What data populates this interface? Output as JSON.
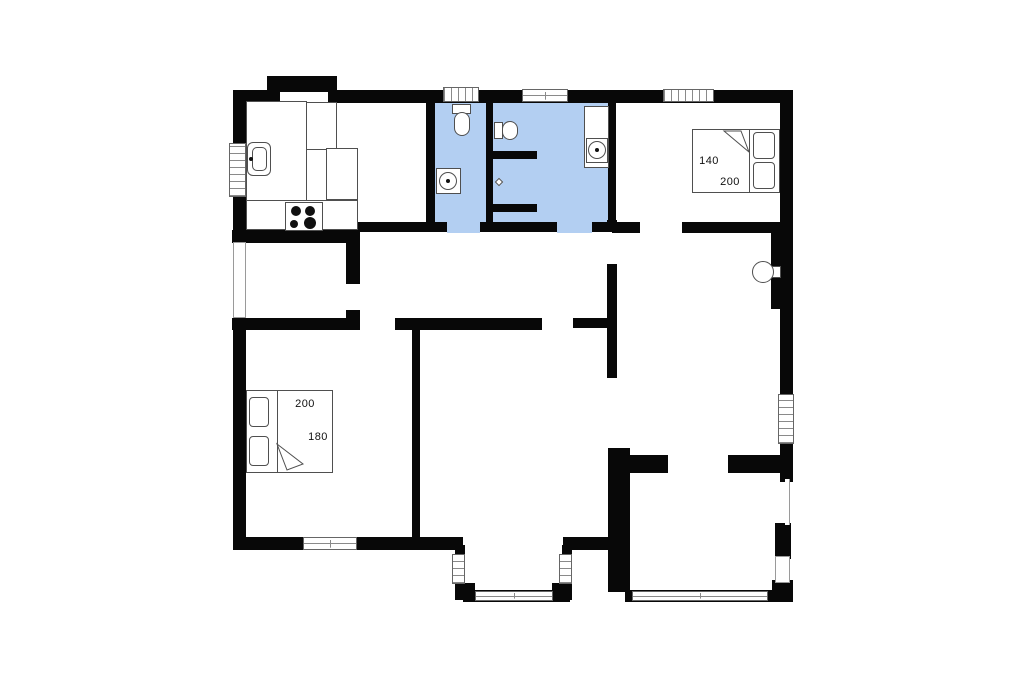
{
  "canvas": {
    "width": 1024,
    "height": 682
  },
  "colors": {
    "wall": "#080808",
    "bathroom_floor": "#b3cff2",
    "outline": "#4f4f4f",
    "window_line": "#8a8a8a",
    "door_line": "#9a9a9a",
    "text": "#101010",
    "background": "#ffffff"
  },
  "floors": [
    {
      "n": "wc-floor",
      "x": 433,
      "y": 100,
      "w": 55,
      "h": 124
    },
    {
      "n": "bathroom-floor",
      "x": 491,
      "y": 100,
      "w": 119,
      "h": 124
    },
    {
      "n": "wc-doorway-floor",
      "x": 447,
      "y": 222,
      "w": 33,
      "h": 11
    },
    {
      "n": "bathroom-doorway-floor",
      "x": 557,
      "y": 222,
      "w": 35,
      "h": 11
    }
  ],
  "walls": [
    {
      "n": "outer-wall-top-left",
      "x": 233,
      "y": 90,
      "w": 47,
      "h": 13
    },
    {
      "n": "outer-wall-top-main",
      "x": 328,
      "y": 90,
      "w": 462,
      "h": 13
    },
    {
      "n": "outer-wall-alcove-bump",
      "x": 267,
      "y": 76,
      "w": 70,
      "h": 16
    },
    {
      "n": "outer-wall-left-1",
      "x": 233,
      "y": 90,
      "w": 13,
      "h": 55
    },
    {
      "n": "outer-wall-left-2",
      "x": 233,
      "y": 196,
      "w": 13,
      "h": 48
    },
    {
      "n": "outer-wall-left-3",
      "x": 233,
      "y": 317,
      "w": 13,
      "h": 233
    },
    {
      "n": "outer-wall-bottom-left",
      "x": 233,
      "y": 537,
      "w": 230,
      "h": 13
    },
    {
      "n": "bay-wall-left",
      "x": 455,
      "y": 545,
      "w": 10,
      "h": 42
    },
    {
      "n": "bay-corner-left",
      "x": 455,
      "y": 583,
      "w": 20,
      "h": 17
    },
    {
      "n": "bay-wall-bottom",
      "x": 463,
      "y": 590,
      "w": 107,
      "h": 12
    },
    {
      "n": "bay-corner-right",
      "x": 552,
      "y": 583,
      "w": 20,
      "h": 17
    },
    {
      "n": "bay-wall-right",
      "x": 562,
      "y": 545,
      "w": 10,
      "h": 42
    },
    {
      "n": "outer-wall-bottom-mid",
      "x": 563,
      "y": 537,
      "w": 57,
      "h": 13
    },
    {
      "n": "outer-wall-right-1",
      "x": 780,
      "y": 90,
      "w": 13,
      "h": 306
    },
    {
      "n": "outer-wall-right-2",
      "x": 780,
      "y": 442,
      "w": 13,
      "h": 40
    },
    {
      "n": "chimney-wall",
      "x": 771,
      "y": 233,
      "w": 22,
      "h": 76
    },
    {
      "n": "right-wall-lower-segment",
      "x": 775,
      "y": 523,
      "w": 16,
      "h": 36
    },
    {
      "n": "right-wall-bottom-corner",
      "x": 772,
      "y": 580,
      "w": 21,
      "h": 22
    },
    {
      "n": "bottomright-room-south-wall",
      "x": 625,
      "y": 590,
      "w": 160,
      "h": 12
    },
    {
      "n": "kitchen-bath-divider",
      "x": 426,
      "y": 103,
      "w": 9,
      "h": 119
    },
    {
      "n": "bathroom-divider",
      "x": 486,
      "y": 103,
      "w": 7,
      "h": 119
    },
    {
      "n": "bath-bedroom-divider",
      "x": 608,
      "y": 103,
      "w": 8,
      "h": 119
    },
    {
      "n": "bath-south-wall-1",
      "x": 346,
      "y": 222,
      "w": 101,
      "h": 10
    },
    {
      "n": "bath-south-wall-2",
      "x": 480,
      "y": 222,
      "w": 77,
      "h": 10
    },
    {
      "n": "bath-south-wall-3",
      "x": 592,
      "y": 222,
      "w": 25,
      "h": 10
    },
    {
      "n": "bedroom-tr-south-wall-1",
      "x": 612,
      "y": 222,
      "w": 28,
      "h": 11
    },
    {
      "n": "bedroom-tr-south-wall-2",
      "x": 682,
      "y": 222,
      "w": 100,
      "h": 11
    },
    {
      "n": "kitchen-south-wall",
      "x": 232,
      "y": 230,
      "w": 126,
      "h": 13
    },
    {
      "n": "corridor-east-wall-1",
      "x": 346,
      "y": 222,
      "w": 14,
      "h": 62
    },
    {
      "n": "corridor-east-wall-2",
      "x": 346,
      "y": 310,
      "w": 14,
      "h": 20
    },
    {
      "n": "bedroom-bl-north-wall",
      "x": 232,
      "y": 318,
      "w": 128,
      "h": 12
    },
    {
      "n": "hall-south-wall-1",
      "x": 395,
      "y": 318,
      "w": 147,
      "h": 12
    },
    {
      "n": "hall-south-wall-2",
      "x": 573,
      "y": 318,
      "w": 44,
      "h": 10
    },
    {
      "n": "center-room-divider",
      "x": 412,
      "y": 320,
      "w": 8,
      "h": 217
    },
    {
      "n": "hall-east-wall-1",
      "x": 607,
      "y": 220,
      "w": 10,
      "h": 12
    },
    {
      "n": "hall-east-wall-2",
      "x": 607,
      "y": 264,
      "w": 10,
      "h": 114
    },
    {
      "n": "living-south-wall-1",
      "x": 608,
      "y": 455,
      "w": 60,
      "h": 18
    },
    {
      "n": "living-south-wall-2",
      "x": 728,
      "y": 455,
      "w": 54,
      "h": 18
    },
    {
      "n": "bottomright-room-west-wall",
      "x": 608,
      "y": 448,
      "w": 22,
      "h": 144
    }
  ],
  "windows": [
    {
      "n": "window-kitchen-left",
      "x": 229,
      "y": 143,
      "w": 17,
      "h": 54,
      "s": "v"
    },
    {
      "n": "window-wc-top",
      "x": 443,
      "y": 87,
      "w": 36,
      "h": 15,
      "s": "h"
    },
    {
      "n": "window-bath-top",
      "x": 522,
      "y": 89,
      "w": 46,
      "h": 13,
      "s": "frame"
    },
    {
      "n": "window-bedroom-tr-top",
      "x": 663,
      "y": 89,
      "w": 51,
      "h": 13,
      "s": "h"
    },
    {
      "n": "window-bedroom-bl-bottom",
      "x": 303,
      "y": 537,
      "w": 54,
      "h": 13,
      "s": "frame"
    },
    {
      "n": "window-bay-left",
      "x": 452,
      "y": 554,
      "w": 13,
      "h": 30,
      "s": "v"
    },
    {
      "n": "window-bay-bottom",
      "x": 475,
      "y": 591,
      "w": 78,
      "h": 10,
      "s": "frame"
    },
    {
      "n": "window-bay-right",
      "x": 559,
      "y": 554,
      "w": 13,
      "h": 30,
      "s": "v"
    },
    {
      "n": "window-right-wall",
      "x": 778,
      "y": 394,
      "w": 16,
      "h": 50,
      "s": "v"
    },
    {
      "n": "window-bottomright-room",
      "x": 632,
      "y": 591,
      "w": 136,
      "h": 10,
      "s": "frame"
    }
  ],
  "doors": [
    {
      "n": "terrace-door-left",
      "x": 233,
      "y": 242,
      "w": 13,
      "h": 76,
      "s": "door"
    },
    {
      "n": "door-bottomright-east",
      "x": 775,
      "y": 556,
      "w": 15,
      "h": 27,
      "s": "door"
    },
    {
      "n": "opening-right-wall",
      "x": 785,
      "y": 479,
      "w": 5,
      "h": 46,
      "s": "gap"
    }
  ],
  "fixtures": [
    {
      "n": "kitchen-alcove-cabinet",
      "t": "rect",
      "x": 267,
      "y": 102,
      "w": 70,
      "h": 48
    },
    {
      "n": "kitchen-counter-left",
      "t": "rect",
      "x": 246,
      "y": 101,
      "w": 61,
      "h": 102
    },
    {
      "n": "kitchen-counter-bottom",
      "t": "rect",
      "x": 246,
      "y": 200,
      "w": 112,
      "h": 30
    },
    {
      "n": "kitchen-peninsula",
      "t": "rect",
      "x": 326,
      "y": 148,
      "w": 32,
      "h": 52
    },
    {
      "n": "kitchen-sink",
      "t": "rect",
      "x": 247,
      "y": 142,
      "w": 24,
      "h": 34,
      "r": 6
    },
    {
      "n": "kitchen-sink-basin",
      "t": "rect",
      "x": 252,
      "y": 147,
      "w": 15,
      "h": 24,
      "r": 5
    },
    {
      "n": "kitchen-sink-faucet",
      "t": "dot",
      "cx": 251,
      "cy": 159,
      "rad": 2
    },
    {
      "n": "stove",
      "t": "rect",
      "x": 285,
      "y": 202,
      "w": 38,
      "h": 29
    },
    {
      "n": "stove-burner-1",
      "t": "dot",
      "cx": 296,
      "cy": 211,
      "rad": 5
    },
    {
      "n": "stove-burner-2",
      "t": "dot",
      "cx": 310,
      "cy": 211,
      "rad": 5
    },
    {
      "n": "stove-burner-3",
      "t": "dot",
      "cx": 294,
      "cy": 224,
      "rad": 4
    },
    {
      "n": "stove-burner-4",
      "t": "dot",
      "cx": 310,
      "cy": 223,
      "rad": 6
    },
    {
      "n": "wc-toilet-tank",
      "t": "rect",
      "x": 452,
      "y": 104,
      "w": 19,
      "h": 10
    },
    {
      "n": "wc-toilet-bowl",
      "t": "rect",
      "x": 454,
      "y": 112,
      "w": 16,
      "h": 24,
      "r": 8
    },
    {
      "n": "wc-washbasin",
      "t": "rect",
      "x": 436,
      "y": 168,
      "w": 25,
      "h": 26
    },
    {
      "n": "wc-washbasin-bowl",
      "t": "circle",
      "cx": 448,
      "cy": 181,
      "rad": 9
    },
    {
      "n": "wc-washbasin-drain",
      "t": "dot",
      "cx": 448,
      "cy": 181,
      "rad": 2
    },
    {
      "n": "bath-toilet-tank",
      "t": "rect",
      "x": 494,
      "y": 122,
      "w": 9,
      "h": 17
    },
    {
      "n": "bath-toilet-bowl",
      "t": "rect",
      "x": 502,
      "y": 121,
      "w": 16,
      "h": 19,
      "r": 8
    },
    {
      "n": "shower-wall-stub-1",
      "t": "stub",
      "x": 493,
      "y": 151,
      "w": 44,
      "h": 8
    },
    {
      "n": "shower-wall-stub-2",
      "t": "stub",
      "x": 493,
      "y": 204,
      "w": 44,
      "h": 8
    },
    {
      "n": "shower-drain",
      "t": "diamond",
      "x": 496,
      "y": 179,
      "w": 6,
      "h": 6
    },
    {
      "n": "bath-vanity",
      "t": "rect",
      "x": 584,
      "y": 106,
      "w": 25,
      "h": 62
    },
    {
      "n": "bath-washbasin",
      "t": "rect",
      "x": 586,
      "y": 138,
      "w": 22,
      "h": 25
    },
    {
      "n": "bath-washbasin-bowl",
      "t": "circle",
      "cx": 597,
      "cy": 150,
      "rad": 9
    },
    {
      "n": "bath-washbasin-drain",
      "t": "dot",
      "cx": 597,
      "cy": 150,
      "rad": 2
    },
    {
      "n": "wood-stove-flue",
      "t": "rect",
      "x": 769,
      "y": 266,
      "w": 12,
      "h": 12
    },
    {
      "n": "wood-stove",
      "t": "circle",
      "cx": 763,
      "cy": 272,
      "rad": 11
    },
    {
      "n": "bed-top-right",
      "t": "rect",
      "x": 692,
      "y": 129,
      "w": 88,
      "h": 64
    },
    {
      "n": "bed-top-right-divider",
      "t": "line",
      "x": 749,
      "y": 130,
      "w": 1,
      "h": 62
    },
    {
      "n": "bed-top-right-pillow-1",
      "t": "rect",
      "x": 753,
      "y": 132,
      "w": 22,
      "h": 27,
      "r": 4
    },
    {
      "n": "bed-top-right-pillow-2",
      "t": "rect",
      "x": 753,
      "y": 162,
      "w": 22,
      "h": 27,
      "r": 4
    },
    {
      "n": "bed-top-right-fold",
      "t": "poly",
      "pts": "724,131 749,152 741,131"
    },
    {
      "n": "bed-bottom-left",
      "t": "rect",
      "x": 246,
      "y": 390,
      "w": 87,
      "h": 83
    },
    {
      "n": "bed-bottom-left-divider",
      "t": "line",
      "x": 277,
      "y": 391,
      "w": 1,
      "h": 81
    },
    {
      "n": "bed-bottom-left-pillow-1",
      "t": "rect",
      "x": 249,
      "y": 397,
      "w": 20,
      "h": 30,
      "r": 4
    },
    {
      "n": "bed-bottom-left-pillow-2",
      "t": "rect",
      "x": 249,
      "y": 436,
      "w": 20,
      "h": 30,
      "r": 4
    },
    {
      "n": "bed-bottom-left-fold",
      "t": "poly",
      "pts": "277,444 303,464 287,470"
    }
  ],
  "labels": [
    {
      "n": "bed-top-right-width-label",
      "text": "140",
      "x": 709,
      "y": 161
    },
    {
      "n": "bed-top-right-length-label",
      "text": "200",
      "x": 730,
      "y": 182
    },
    {
      "n": "bed-bottom-left-width-label",
      "text": "200",
      "x": 305,
      "y": 404
    },
    {
      "n": "bed-bottom-left-length-label",
      "text": "180",
      "x": 318,
      "y": 437
    }
  ]
}
